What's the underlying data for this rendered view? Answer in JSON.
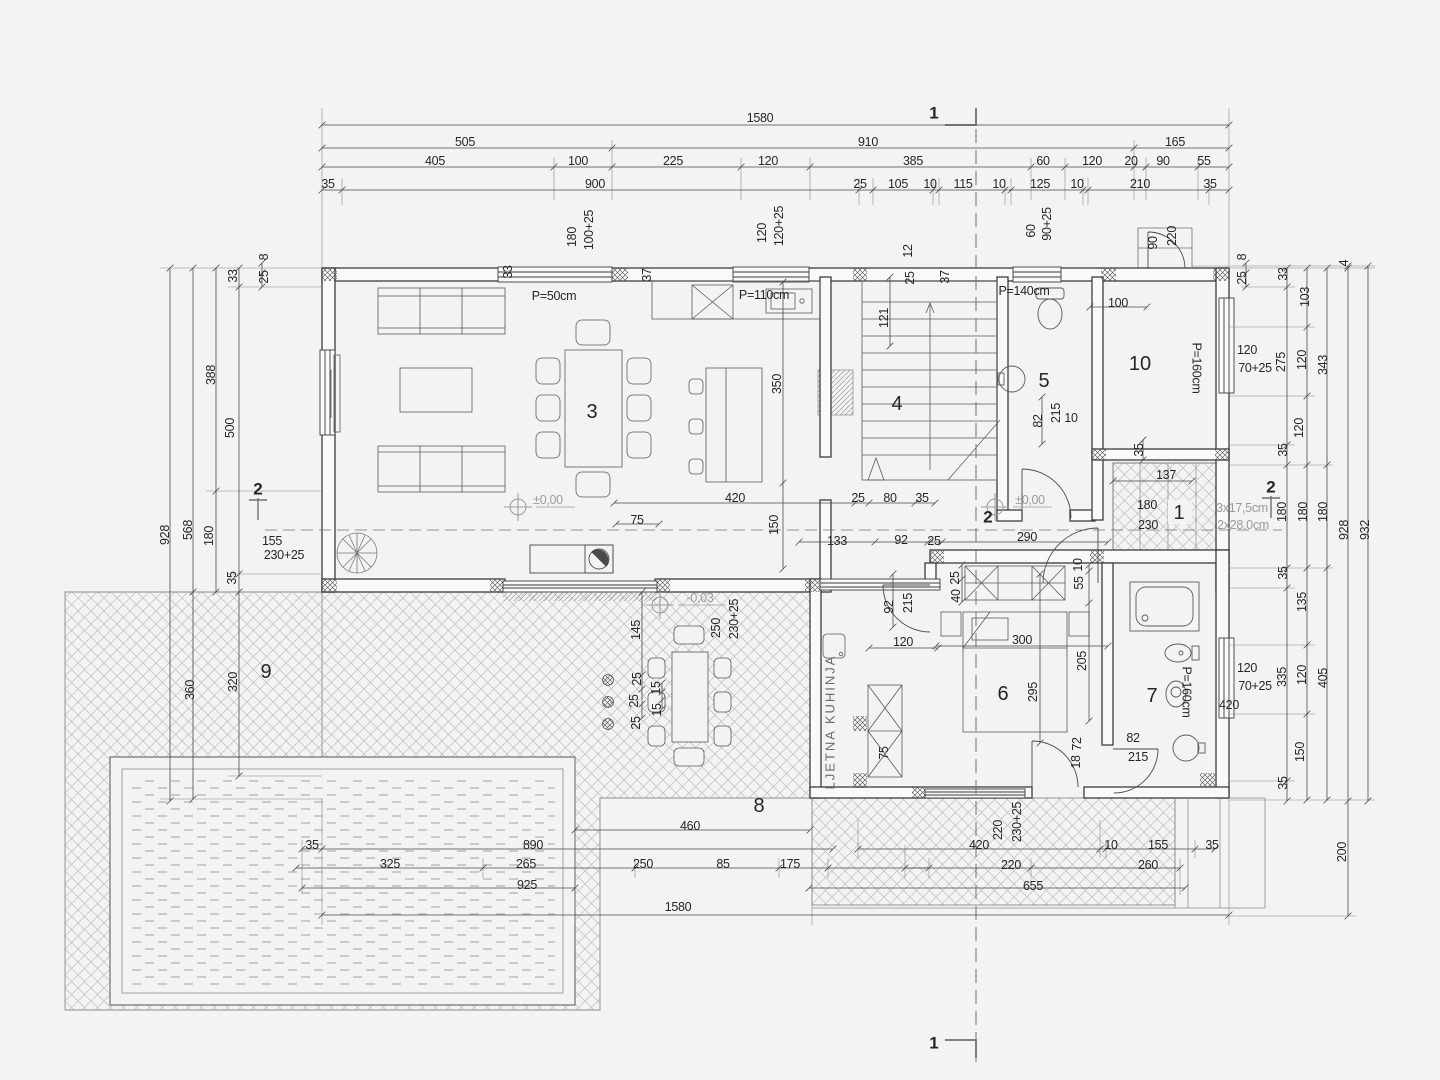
{
  "document": {
    "kind": "architectural floor plan (ground floor with pool and terraces)",
    "drawing_language": "Croatian",
    "section_marks": [
      "1",
      "2"
    ],
    "level_marks": [
      "±0,00",
      "-0,03"
    ],
    "room_numbers": [
      "1",
      "2",
      "3",
      "4",
      "5",
      "6",
      "7",
      "8",
      "9",
      "10"
    ],
    "room_text": {
      "summer_kitchen": "LJETNA KUHINJA"
    },
    "colors": {
      "line": "#3c3c3c",
      "dim": "#4a4a4a",
      "hatch": "#bdbdbd",
      "grey_text": "#9b9b9b",
      "paper": "#f3f3f2"
    }
  },
  "labels": [
    {
      "t": "1580",
      "x": 760,
      "y": 118
    },
    {
      "t": "505",
      "x": 465,
      "y": 142
    },
    {
      "t": "910",
      "x": 868,
      "y": 142
    },
    {
      "t": "165",
      "x": 1175,
      "y": 142
    },
    {
      "t": "405",
      "x": 435,
      "y": 161
    },
    {
      "t": "100",
      "x": 578,
      "y": 161
    },
    {
      "t": "225",
      "x": 673,
      "y": 161
    },
    {
      "t": "120",
      "x": 768,
      "y": 161
    },
    {
      "t": "385",
      "x": 913,
      "y": 161
    },
    {
      "t": "60",
      "x": 1043,
      "y": 161
    },
    {
      "t": "120",
      "x": 1092,
      "y": 161
    },
    {
      "t": "20",
      "x": 1131,
      "y": 161
    },
    {
      "t": "90",
      "x": 1163,
      "y": 161
    },
    {
      "t": "55",
      "x": 1204,
      "y": 161
    },
    {
      "t": "35",
      "x": 328,
      "y": 184
    },
    {
      "t": "900",
      "x": 595,
      "y": 184
    },
    {
      "t": "25",
      "x": 860,
      "y": 184
    },
    {
      "t": "105",
      "x": 898,
      "y": 184
    },
    {
      "t": "10",
      "x": 930,
      "y": 184
    },
    {
      "t": "115",
      "x": 963,
      "y": 184
    },
    {
      "t": "10",
      "x": 999,
      "y": 184
    },
    {
      "t": "125",
      "x": 1040,
      "y": 184
    },
    {
      "t": "10",
      "x": 1077,
      "y": 184
    },
    {
      "t": "210",
      "x": 1140,
      "y": 184
    },
    {
      "t": "35",
      "x": 1210,
      "y": 184
    },
    {
      "t": "1",
      "x": 934,
      "y": 113,
      "s": "sec",
      "n": "section-marker-1-top"
    },
    {
      "t": "1",
      "x": 934,
      "y": 1043,
      "s": "sec",
      "n": "section-marker-1-bottom"
    },
    {
      "t": "2",
      "x": 258,
      "y": 489,
      "s": "sec",
      "n": "section-marker-2-left"
    },
    {
      "t": "2",
      "x": 988,
      "y": 517,
      "s": "sec",
      "n": "section-marker-2-mid"
    },
    {
      "t": "2",
      "x": 1271,
      "y": 487,
      "s": "sec",
      "n": "section-marker-2-right"
    },
    {
      "t": "33",
      "x": 508,
      "y": 272,
      "r": -90
    },
    {
      "t": "180",
      "x": 572,
      "y": 237,
      "r": -90
    },
    {
      "t": "100+25",
      "x": 589,
      "y": 230,
      "r": -90
    },
    {
      "t": "37",
      "x": 647,
      "y": 275,
      "r": -90
    },
    {
      "t": "120",
      "x": 762,
      "y": 233,
      "r": -90
    },
    {
      "t": "120+25",
      "x": 779,
      "y": 226,
      "r": -90
    },
    {
      "t": "12",
      "x": 908,
      "y": 251,
      "r": -90
    },
    {
      "t": "25",
      "x": 910,
      "y": 278,
      "r": -90
    },
    {
      "t": "37",
      "x": 945,
      "y": 277,
      "r": -90
    },
    {
      "t": "60",
      "x": 1031,
      "y": 231,
      "r": -90
    },
    {
      "t": "90+25",
      "x": 1047,
      "y": 224,
      "r": -90
    },
    {
      "t": "90",
      "x": 1153,
      "y": 243,
      "r": -90
    },
    {
      "t": "220",
      "x": 1172,
      "y": 236,
      "r": -90
    },
    {
      "t": "P=50cm",
      "x": 554,
      "y": 296,
      "n": "window-sill-label"
    },
    {
      "t": "P=110cm",
      "x": 764,
      "y": 295,
      "n": "window-sill-label"
    },
    {
      "t": "P=140cm",
      "x": 1024,
      "y": 291,
      "n": "window-sill-label"
    },
    {
      "t": "P=160cm",
      "x": 1196,
      "y": 368,
      "r": 90,
      "n": "window-sill-label"
    },
    {
      "t": "P=160cm",
      "x": 1186,
      "y": 692,
      "r": 90,
      "n": "window-sill-label"
    },
    {
      "t": "8",
      "x": 264,
      "y": 257,
      "r": -90
    },
    {
      "t": "25",
      "x": 264,
      "y": 277,
      "r": -90
    },
    {
      "t": "33",
      "x": 233,
      "y": 276,
      "r": -90
    },
    {
      "t": "388",
      "x": 211,
      "y": 375,
      "r": -90
    },
    {
      "t": "500",
      "x": 230,
      "y": 428,
      "r": -90
    },
    {
      "t": "568",
      "x": 188,
      "y": 530,
      "r": -90
    },
    {
      "t": "928",
      "x": 165,
      "y": 535,
      "r": -90
    },
    {
      "t": "180",
      "x": 209,
      "y": 536,
      "r": -90
    },
    {
      "t": "35",
      "x": 232,
      "y": 578,
      "r": -90
    },
    {
      "t": "360",
      "x": 190,
      "y": 690,
      "r": -90
    },
    {
      "t": "320",
      "x": 233,
      "y": 682,
      "r": -90
    },
    {
      "t": "155",
      "x": 272,
      "y": 541
    },
    {
      "t": "230+25",
      "x": 284,
      "y": 555
    },
    {
      "t": "8",
      "x": 1242,
      "y": 257,
      "r": -90
    },
    {
      "t": "25",
      "x": 1242,
      "y": 278,
      "r": -90
    },
    {
      "t": "33",
      "x": 1283,
      "y": 274,
      "r": -90
    },
    {
      "t": "103",
      "x": 1305,
      "y": 297,
      "r": -90
    },
    {
      "t": "4",
      "x": 1344,
      "y": 263,
      "r": -90
    },
    {
      "t": "275",
      "x": 1281,
      "y": 362,
      "r": -90
    },
    {
      "t": "120",
      "x": 1302,
      "y": 360,
      "r": -90
    },
    {
      "t": "343",
      "x": 1323,
      "y": 365,
      "r": -90
    },
    {
      "t": "120",
      "x": 1299,
      "y": 428,
      "r": -90
    },
    {
      "t": "35",
      "x": 1283,
      "y": 450,
      "r": -90
    },
    {
      "t": "120",
      "x": 1247,
      "y": 350
    },
    {
      "t": "70+25",
      "x": 1255,
      "y": 368
    },
    {
      "t": "180",
      "x": 1282,
      "y": 512,
      "r": -90
    },
    {
      "t": "180",
      "x": 1303,
      "y": 512,
      "r": -90
    },
    {
      "t": "180",
      "x": 1323,
      "y": 512,
      "r": -90
    },
    {
      "t": "928",
      "x": 1344,
      "y": 530,
      "r": -90
    },
    {
      "t": "932",
      "x": 1365,
      "y": 530,
      "r": -90
    },
    {
      "t": "35",
      "x": 1283,
      "y": 573,
      "r": -90
    },
    {
      "t": "135",
      "x": 1302,
      "y": 602,
      "r": -90
    },
    {
      "t": "335",
      "x": 1282,
      "y": 677,
      "r": -90
    },
    {
      "t": "120",
      "x": 1302,
      "y": 675,
      "r": -90
    },
    {
      "t": "405",
      "x": 1323,
      "y": 678,
      "r": -90
    },
    {
      "t": "120",
      "x": 1247,
      "y": 668
    },
    {
      "t": "70+25",
      "x": 1255,
      "y": 686
    },
    {
      "t": "420",
      "x": 1229,
      "y": 705
    },
    {
      "t": "150",
      "x": 1300,
      "y": 752,
      "r": -90
    },
    {
      "t": "35",
      "x": 1283,
      "y": 783,
      "r": -90
    },
    {
      "t": "200",
      "x": 1342,
      "y": 852,
      "r": -90
    },
    {
      "t": "350",
      "x": 777,
      "y": 384,
      "r": -90
    },
    {
      "t": "121",
      "x": 884,
      "y": 318,
      "r": -90
    },
    {
      "t": "100",
      "x": 1118,
      "y": 303
    },
    {
      "t": "±0,00",
      "x": 548,
      "y": 500,
      "c": "grey",
      "n": "level-marker-label"
    },
    {
      "t": "±0,00",
      "x": 1030,
      "y": 500,
      "c": "grey",
      "n": "level-marker-label"
    },
    {
      "t": "75",
      "x": 637,
      "y": 520
    },
    {
      "t": "150",
      "x": 774,
      "y": 525,
      "r": -90
    },
    {
      "t": "420",
      "x": 735,
      "y": 498
    },
    {
      "t": "25",
      "x": 858,
      "y": 498
    },
    {
      "t": "80",
      "x": 890,
      "y": 498
    },
    {
      "t": "35",
      "x": 922,
      "y": 498
    },
    {
      "t": "133",
      "x": 837,
      "y": 541
    },
    {
      "t": "92",
      "x": 901,
      "y": 540
    },
    {
      "t": "25",
      "x": 934,
      "y": 541
    },
    {
      "t": "290",
      "x": 1027,
      "y": 537
    },
    {
      "t": "82",
      "x": 1038,
      "y": 421,
      "r": -90
    },
    {
      "t": "215",
      "x": 1056,
      "y": 413,
      "r": -90
    },
    {
      "t": "10",
      "x": 1071,
      "y": 418
    },
    {
      "t": "35",
      "x": 1139,
      "y": 450,
      "r": -90
    },
    {
      "t": "137",
      "x": 1166,
      "y": 475
    },
    {
      "t": "180",
      "x": 1147,
      "y": 505
    },
    {
      "t": "230",
      "x": 1148,
      "y": 525
    },
    {
      "t": "3x17,5cm",
      "x": 1242,
      "y": 508,
      "c": "grey",
      "n": "stair-note"
    },
    {
      "t": "2x28,0cm",
      "x": 1243,
      "y": 525,
      "c": "grey",
      "n": "stair-note"
    },
    {
      "t": "3",
      "x": 592,
      "y": 412,
      "s": "room",
      "n": "room-number-3"
    },
    {
      "t": "4",
      "x": 897,
      "y": 404,
      "s": "room",
      "n": "room-number-4"
    },
    {
      "t": "5",
      "x": 1044,
      "y": 381,
      "s": "room",
      "n": "room-number-5"
    },
    {
      "t": "10",
      "x": 1140,
      "y": 364,
      "s": "room",
      "n": "room-number-10"
    },
    {
      "t": "1",
      "x": 1179,
      "y": 513,
      "s": "room",
      "n": "room-number-1"
    },
    {
      "t": "6",
      "x": 1003,
      "y": 694,
      "s": "room",
      "n": "room-number-6"
    },
    {
      "t": "7",
      "x": 1152,
      "y": 696,
      "s": "room",
      "n": "room-number-7"
    },
    {
      "t": "8",
      "x": 759,
      "y": 806,
      "s": "room",
      "n": "room-number-8"
    },
    {
      "t": "9",
      "x": 266,
      "y": 672,
      "s": "room",
      "n": "room-number-9"
    },
    {
      "t": "-0,03",
      "x": 700,
      "y": 598,
      "c": "grey",
      "n": "level-marker-label"
    },
    {
      "t": "250",
      "x": 716,
      "y": 628,
      "r": -90
    },
    {
      "t": "230+25",
      "x": 734,
      "y": 619,
      "r": -90
    },
    {
      "t": "145",
      "x": 636,
      "y": 630,
      "r": -90
    },
    {
      "t": "25",
      "x": 637,
      "y": 679,
      "r": -90
    },
    {
      "t": "25",
      "x": 634,
      "y": 701,
      "r": -90
    },
    {
      "t": "25",
      "x": 636,
      "y": 723,
      "r": -90
    },
    {
      "t": "15",
      "x": 656,
      "y": 688,
      "r": -90
    },
    {
      "t": "15",
      "x": 657,
      "y": 710,
      "r": -90
    },
    {
      "t": "92",
      "x": 889,
      "y": 607,
      "r": -90
    },
    {
      "t": "215",
      "x": 908,
      "y": 603,
      "r": -90
    },
    {
      "t": "120",
      "x": 903,
      "y": 642
    },
    {
      "t": "25",
      "x": 955,
      "y": 578,
      "r": -90
    },
    {
      "t": "40",
      "x": 956,
      "y": 596,
      "r": -90
    },
    {
      "t": "10",
      "x": 1078,
      "y": 565,
      "r": -90
    },
    {
      "t": "55",
      "x": 1079,
      "y": 583,
      "r": -90
    },
    {
      "t": "300",
      "x": 1022,
      "y": 640
    },
    {
      "t": "205",
      "x": 1082,
      "y": 661,
      "r": -90
    },
    {
      "t": "295",
      "x": 1033,
      "y": 692,
      "r": -90
    },
    {
      "t": "75",
      "x": 884,
      "y": 753,
      "r": -90
    },
    {
      "t": "72",
      "x": 1077,
      "y": 744,
      "r": -90
    },
    {
      "t": "18",
      "x": 1076,
      "y": 762,
      "r": -90
    },
    {
      "t": "82",
      "x": 1133,
      "y": 738
    },
    {
      "t": "215",
      "x": 1138,
      "y": 757
    },
    {
      "t": "LJETNA KUHINJA",
      "x": 830,
      "y": 722,
      "s": "kuh",
      "n": "room-label-summer-kitchen"
    },
    {
      "t": "460",
      "x": 690,
      "y": 826
    },
    {
      "t": "35",
      "x": 312,
      "y": 845
    },
    {
      "t": "890",
      "x": 533,
      "y": 845
    },
    {
      "t": "325",
      "x": 390,
      "y": 864
    },
    {
      "t": "265",
      "x": 526,
      "y": 864
    },
    {
      "t": "250",
      "x": 643,
      "y": 864
    },
    {
      "t": "85",
      "x": 723,
      "y": 864
    },
    {
      "t": "175",
      "x": 790,
      "y": 864
    },
    {
      "t": "925",
      "x": 527,
      "y": 885
    },
    {
      "t": "220",
      "x": 998,
      "y": 830,
      "r": -90
    },
    {
      "t": "230+25",
      "x": 1017,
      "y": 822,
      "r": -90
    },
    {
      "t": "420",
      "x": 979,
      "y": 845
    },
    {
      "t": "10",
      "x": 1111,
      "y": 845
    },
    {
      "t": "155",
      "x": 1158,
      "y": 845
    },
    {
      "t": "35",
      "x": 1212,
      "y": 845
    },
    {
      "t": "220",
      "x": 1011,
      "y": 865
    },
    {
      "t": "260",
      "x": 1148,
      "y": 865
    },
    {
      "t": "655",
      "x": 1033,
      "y": 886
    },
    {
      "t": "1580",
      "x": 678,
      "y": 907
    }
  ]
}
